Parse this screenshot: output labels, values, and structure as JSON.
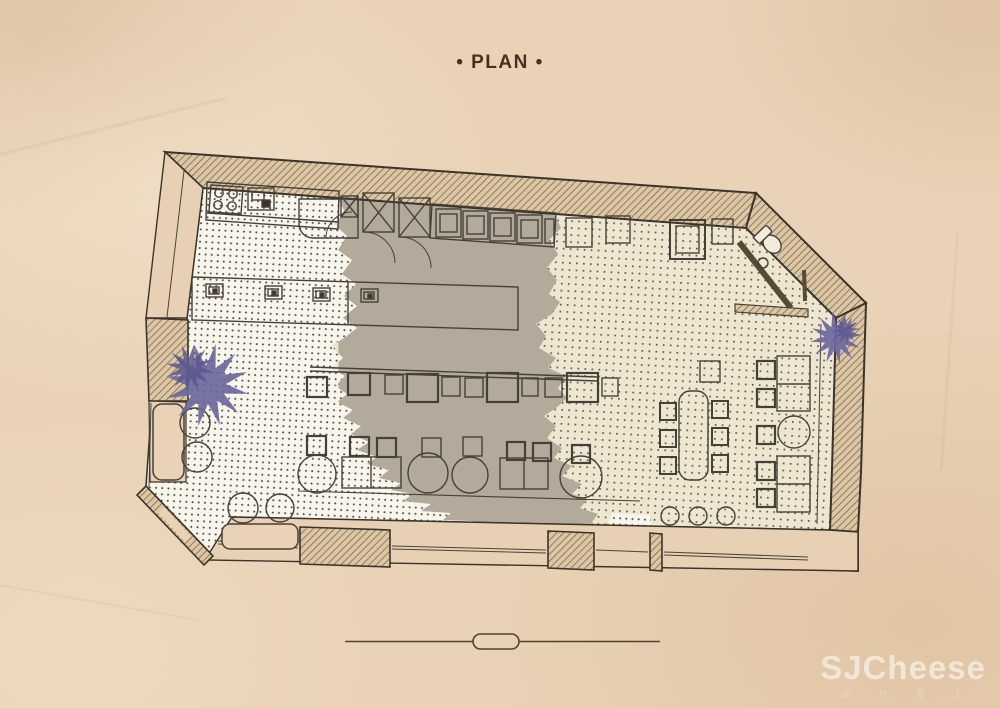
{
  "header": {
    "title": "• PLAN •"
  },
  "watermark": {
    "text": "SJCheese",
    "subtext": "设 计 至 上"
  },
  "colors": {
    "paper": "#e9d2b6",
    "ink": "#3b342a",
    "line": "#474038",
    "wall_fill": "#dcc6a4",
    "wall_hatch": "#6d5d45",
    "floor_white": "#f8f5ec",
    "floor_cream": "#eee6d0",
    "floor_gray": "#b3aa9b",
    "dot_white_zone": "#4e4940",
    "dot_cream_zone": "#5f584a",
    "plant": "#6b689c",
    "plant_dark": "#5a578e",
    "title_ink": "#46311f",
    "divider_ink": "#4e4232",
    "watermark_white": "rgba(255,255,255,0.55)"
  },
  "plan": {
    "drawing_type": "cafe floor plan",
    "areas": [
      "kitchen",
      "service-doors",
      "equipment-counter",
      "bar-counter",
      "stool-counter",
      "dining-area",
      "communal-table",
      "wc",
      "corner-entrance",
      "window-benches"
    ],
    "symbols": [
      "plant-icon",
      "toilet-icon",
      "stove-icon",
      "door-swing-icon",
      "scale-divider"
    ]
  }
}
